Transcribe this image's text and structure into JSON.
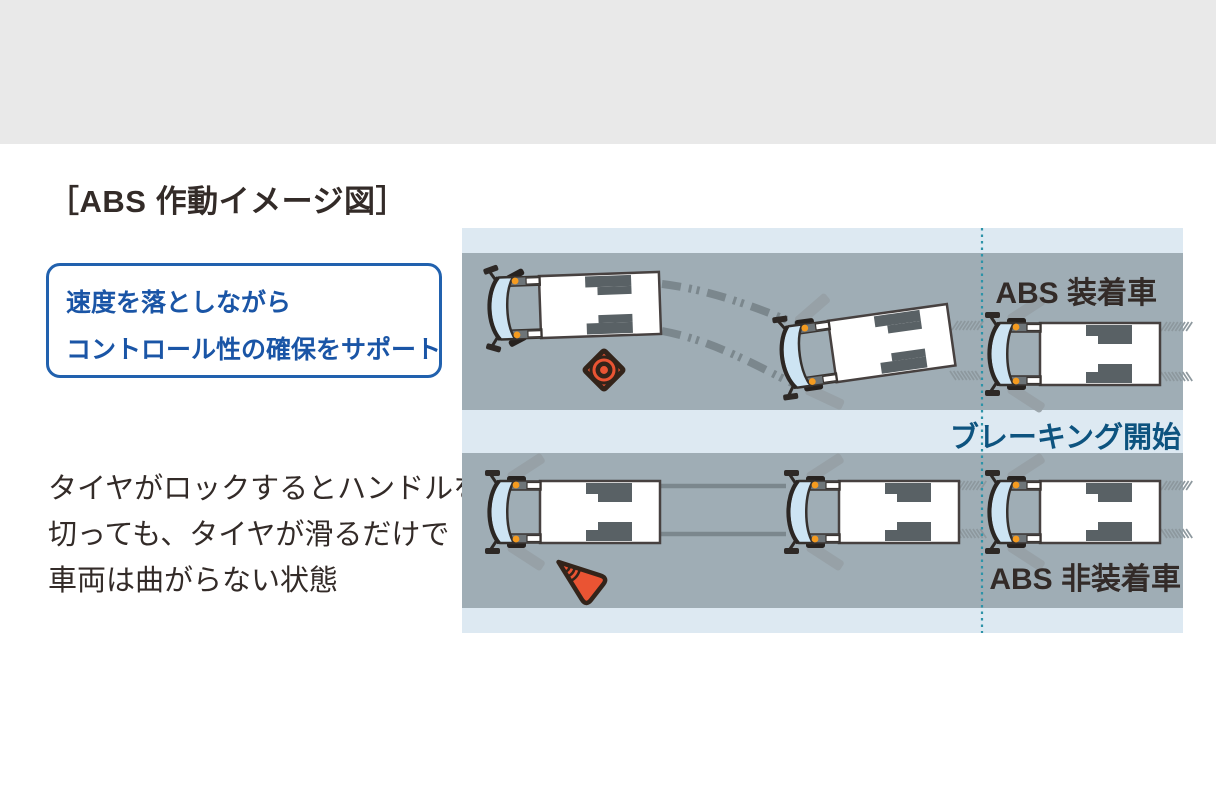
{
  "page": {
    "top_band_color": "#e9e9e9",
    "background_color": "#ffffff"
  },
  "title": "［ABS 作動イメージ図］",
  "callout": {
    "line1": "速度を落としながら",
    "line2": "コントロール性の確保をサポート",
    "border_color": "#2161ae",
    "text_color": "#1a55a6"
  },
  "description": {
    "line1": "タイヤがロックするとハンドルを",
    "line2": "切っても、タイヤが滑るだけで",
    "line3": "車両は曲がらない状態",
    "text_color": "#332b28"
  },
  "diagram": {
    "labels": {
      "abs_equipped": "ABS 装着車",
      "braking_start": "ブレーキング開始",
      "abs_not_equipped": "ABS 非装着車"
    },
    "icons": [
      "truck-top-view",
      "traffic-cone-top-view",
      "traffic-cone-fallen",
      "skid-mark-dashed",
      "skid-mark-straight",
      "braking-start-dotted-line"
    ],
    "colors": {
      "road": "#9fadb5",
      "strip": "#dde9f2",
      "skid": "#7b878d",
      "hatch": "#8d989e",
      "dotted_line": "#2d93a8",
      "wheel": "#596165",
      "streak": "#96a0a5",
      "truck_outline": "#474140",
      "windshield": "#cde4f3",
      "marker_light": "#f59b20",
      "cone_orange": "#ea5433",
      "cone_outline": "#33241a",
      "label_text": "#332b28",
      "braking_text": "#0d537f"
    }
  }
}
